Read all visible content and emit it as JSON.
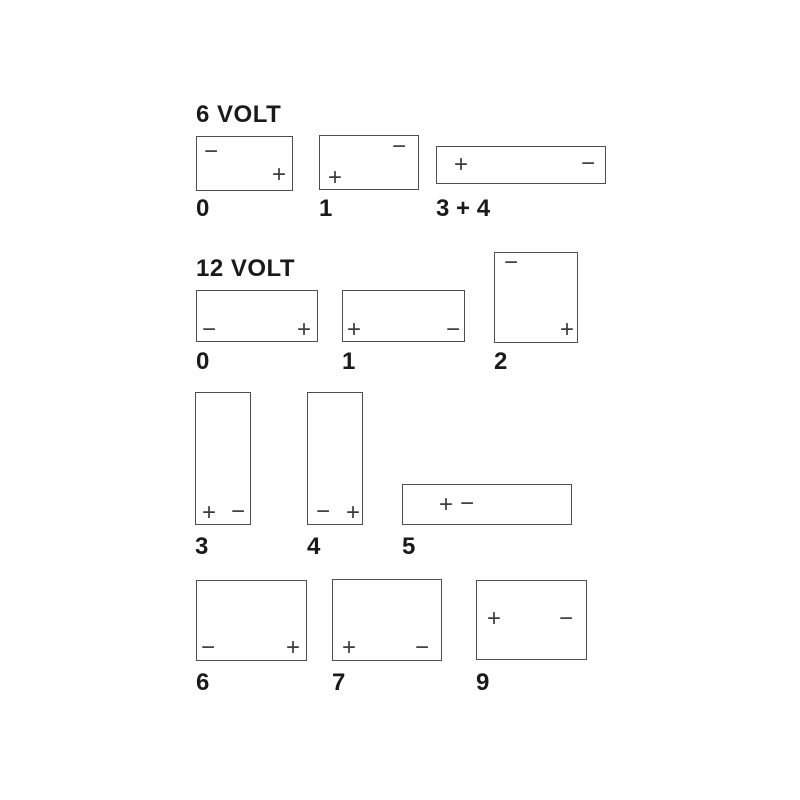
{
  "page": {
    "background": "#ffffff",
    "line_color": "#4f4f4f",
    "sign_color": "#3d3d3d",
    "label_color": "#1a1a1a",
    "plus_sign": "+",
    "minus_sign": "−"
  },
  "sections": [
    {
      "id": "6-volt",
      "title": "6 VOLT",
      "title_pos": {
        "x": 196,
        "y": 102
      },
      "batteries": [
        {
          "label": "0",
          "box": {
            "x": 196,
            "y": 136,
            "w": 97,
            "h": 55
          },
          "terminals": [
            {
              "sign": "−",
              "x": 14,
              "y": 15
            },
            {
              "sign": "+",
              "x": 82,
              "y": 38
            }
          ],
          "label_pos": {
            "x": 196,
            "y": 196
          }
        },
        {
          "label": "1",
          "box": {
            "x": 319,
            "y": 135,
            "w": 100,
            "h": 55
          },
          "terminals": [
            {
              "sign": "−",
              "x": 79,
              "y": 11
            },
            {
              "sign": "+",
              "x": 15,
              "y": 42
            }
          ],
          "label_pos": {
            "x": 319,
            "y": 196
          }
        },
        {
          "label": "3 + 4",
          "box": {
            "x": 436,
            "y": 146,
            "w": 170,
            "h": 38
          },
          "terminals": [
            {
              "sign": "+",
              "x": 24,
              "y": 18
            },
            {
              "sign": "−",
              "x": 151,
              "y": 17
            }
          ],
          "label_pos": {
            "x": 436,
            "y": 196
          }
        }
      ]
    },
    {
      "id": "12-volt",
      "title": "12 VOLT",
      "title_pos": {
        "x": 196,
        "y": 256
      },
      "batteries": [
        {
          "label": "0",
          "box": {
            "x": 196,
            "y": 290,
            "w": 122,
            "h": 52
          },
          "terminals": [
            {
              "sign": "−",
              "x": 12,
              "y": 39
            },
            {
              "sign": "+",
              "x": 107,
              "y": 39
            }
          ],
          "label_pos": {
            "x": 196,
            "y": 349
          }
        },
        {
          "label": "1",
          "box": {
            "x": 342,
            "y": 290,
            "w": 123,
            "h": 52
          },
          "terminals": [
            {
              "sign": "+",
              "x": 11,
              "y": 39
            },
            {
              "sign": "−",
              "x": 110,
              "y": 39
            }
          ],
          "label_pos": {
            "x": 342,
            "y": 349
          }
        },
        {
          "label": "2",
          "box": {
            "x": 494,
            "y": 252,
            "w": 84,
            "h": 91
          },
          "terminals": [
            {
              "sign": "−",
              "x": 16,
              "y": 10
            },
            {
              "sign": "+",
              "x": 72,
              "y": 77
            }
          ],
          "label_pos": {
            "x": 494,
            "y": 349
          }
        },
        {
          "label": "3",
          "box": {
            "x": 195,
            "y": 392,
            "w": 56,
            "h": 133
          },
          "terminals": [
            {
              "sign": "+",
              "x": 13,
              "y": 120
            },
            {
              "sign": "−",
              "x": 42,
              "y": 119
            }
          ],
          "label_pos": {
            "x": 195,
            "y": 534
          }
        },
        {
          "label": "4",
          "box": {
            "x": 307,
            "y": 392,
            "w": 56,
            "h": 133
          },
          "terminals": [
            {
              "sign": "−",
              "x": 15,
              "y": 119
            },
            {
              "sign": "+",
              "x": 45,
              "y": 120
            }
          ],
          "label_pos": {
            "x": 307,
            "y": 534
          }
        },
        {
          "label": "5",
          "box": {
            "x": 402,
            "y": 484,
            "w": 170,
            "h": 41
          },
          "terminals": [
            {
              "sign": "+",
              "x": 43,
              "y": 20
            },
            {
              "sign": "−",
              "x": 64,
              "y": 19
            }
          ],
          "label_pos": {
            "x": 402,
            "y": 534
          }
        },
        {
          "label": "6",
          "box": {
            "x": 196,
            "y": 580,
            "w": 111,
            "h": 81
          },
          "terminals": [
            {
              "sign": "−",
              "x": 11,
              "y": 67
            },
            {
              "sign": "+",
              "x": 96,
              "y": 67
            }
          ],
          "label_pos": {
            "x": 196,
            "y": 670
          }
        },
        {
          "label": "7",
          "box": {
            "x": 332,
            "y": 579,
            "w": 110,
            "h": 82
          },
          "terminals": [
            {
              "sign": "+",
              "x": 16,
              "y": 68
            },
            {
              "sign": "−",
              "x": 89,
              "y": 68
            }
          ],
          "label_pos": {
            "x": 332,
            "y": 670
          }
        },
        {
          "label": "9",
          "box": {
            "x": 476,
            "y": 580,
            "w": 111,
            "h": 80
          },
          "terminals": [
            {
              "sign": "+",
              "x": 17,
              "y": 38
            },
            {
              "sign": "−",
              "x": 89,
              "y": 38
            }
          ],
          "label_pos": {
            "x": 476,
            "y": 670
          }
        }
      ]
    }
  ]
}
